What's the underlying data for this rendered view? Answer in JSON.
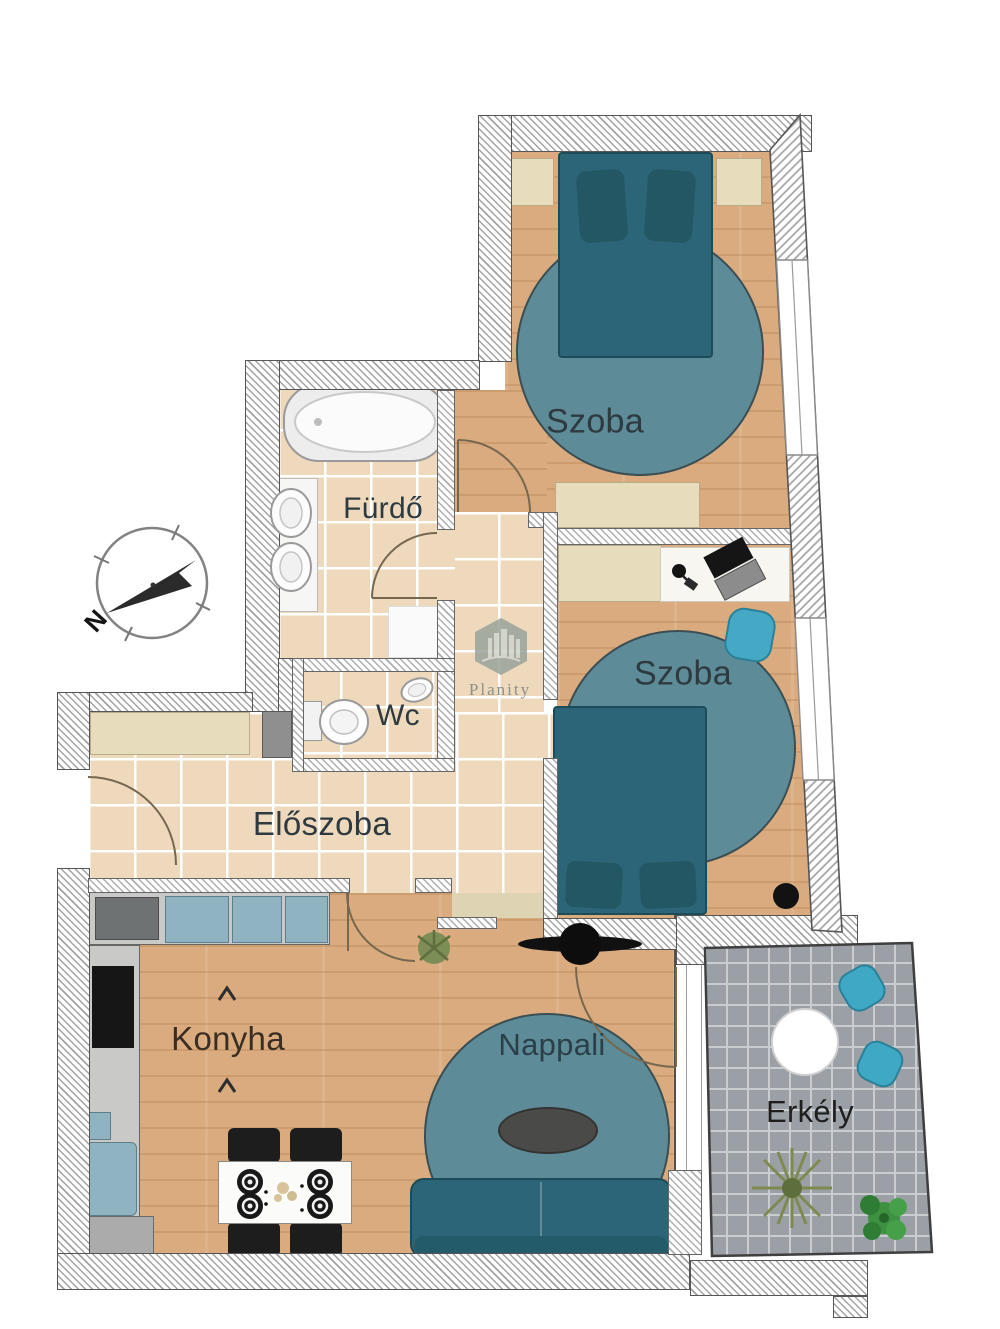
{
  "title": "Apartment floor plan",
  "watermark": {
    "brand": "Planity"
  },
  "compass": {
    "north_label": "N"
  },
  "rooms": {
    "szoba1": {
      "label": "Szoba"
    },
    "szoba2": {
      "label": "Szoba"
    },
    "furdo": {
      "label": "Fürdő"
    },
    "wc": {
      "label": "Wc"
    },
    "eloszoba": {
      "label": "Előszoba"
    },
    "konyha": {
      "label": "Konyha"
    },
    "nappali": {
      "label": "Nappali"
    },
    "erkely": {
      "label": "Erkély"
    }
  },
  "objects": [
    "double-bed",
    "round-rug",
    "nightstand",
    "dresser",
    "wardrobe",
    "desk",
    "laptop",
    "desk-chair",
    "bathtub",
    "washbasin",
    "toilet",
    "shoe-cabinet",
    "kitchen-counter",
    "oven",
    "fridge",
    "washing-machine",
    "dining-table",
    "dining-chair",
    "plate",
    "sofa",
    "coffee-table",
    "ceiling-fan",
    "plant",
    "balcony-table",
    "balcony-chair",
    "compass-rose",
    "brand-watermark"
  ],
  "palette": {
    "wood_floor": "#d9ab7e",
    "tile_floor": "#eed9bd",
    "tile_grout": "#ffffff",
    "wall_hatch": "#a2a2a2",
    "wall_border": "#555555",
    "furniture_teal": "#2c6577",
    "rug_teal": "#5d8c98",
    "accent_cyan": "#45a9c5",
    "cabinet_blue": "#8fb3c0",
    "counter_gray": "#c9cac8",
    "balcony_gray": "#9aa0a5",
    "label_color": "#2e3a40",
    "watermark_gray": "#9aa39c"
  }
}
